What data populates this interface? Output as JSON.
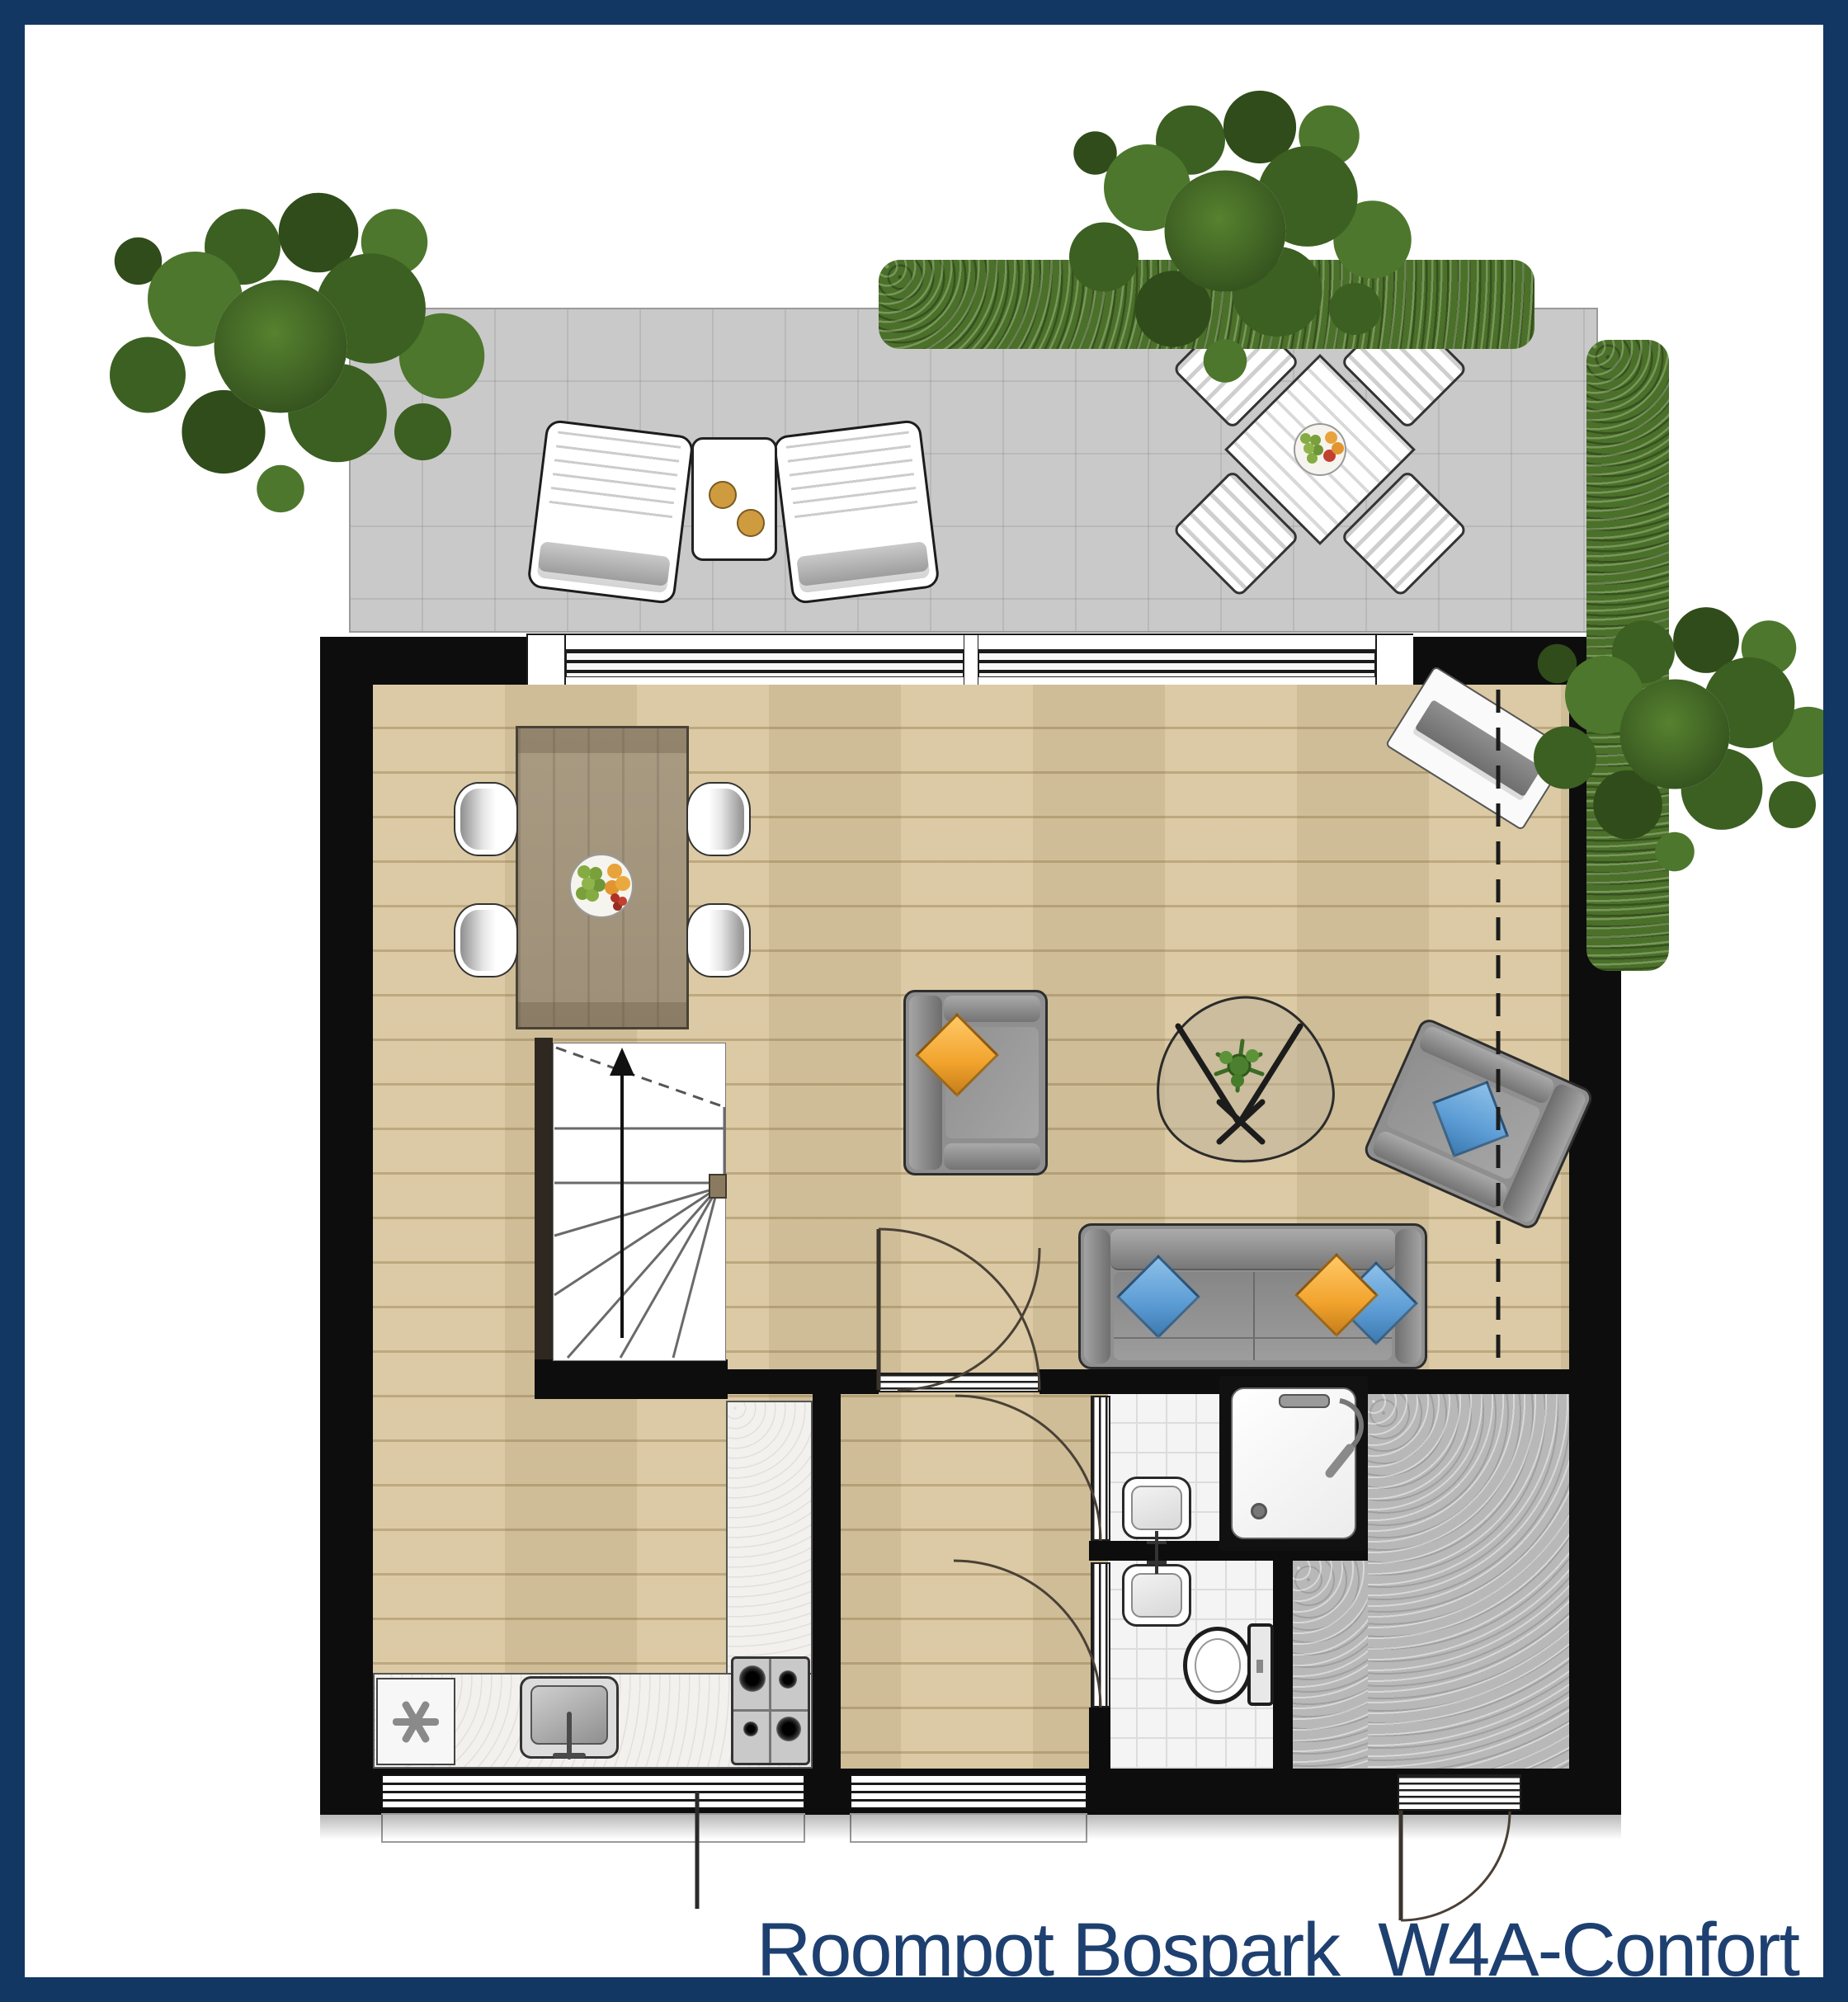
{
  "title": {
    "label": "Roompot Bospark  W4A-Confort"
  },
  "colors": {
    "navy_frame": "#123763",
    "navy_text": "#1e4070",
    "wall": "#0d0d0d",
    "wood": "#d9c79f",
    "wood_line": "#c2ab7e",
    "terrace": "#c9c9c9",
    "terrace_line": "#b4b4b4",
    "hall": "#b8b8b8",
    "tile": "#f4f4f4",
    "tile_line": "#dcdcdc",
    "counter": "#f2f1ee",
    "table_wood": "#a59681",
    "table_wood_dark": "#8d7f6c",
    "sofa": "#8f8f8f",
    "sofa_dark": "#6f6f6f",
    "sofa_outline": "#2d2d2d",
    "cushion_orange": "#f2a32d",
    "cushion_blue": "#5b9bd4",
    "green_dark": "#35541f",
    "green_mid": "#4a7029",
    "green_light": "#65923a",
    "stair_wall": "#2e2820",
    "chair_white": "#ffffff"
  },
  "floorplan": {
    "unit_label": "W4A-Confort",
    "rooms": [
      {
        "name": "terrace",
        "floor": "grey-tiles"
      },
      {
        "name": "living-dining-area",
        "floor": "wood"
      },
      {
        "name": "kitchen",
        "floor": "wood"
      },
      {
        "name": "hallway",
        "floor": "wood"
      },
      {
        "name": "bathroom",
        "floor": "white-tiles",
        "fixtures": [
          "shower",
          "washbasin"
        ]
      },
      {
        "name": "toilet-room",
        "floor": "white-tiles",
        "fixtures": [
          "toilet",
          "washbasin"
        ]
      },
      {
        "name": "entrance-hall",
        "floor": "stone"
      }
    ],
    "furniture": [
      "lounge-chair",
      "lounge-chair",
      "lounge-side-table",
      "terrace-dining-table",
      "terrace-chair",
      "terrace-chair",
      "terrace-chair",
      "terrace-chair",
      "dining-table",
      "dining-chair",
      "dining-chair",
      "dining-chair",
      "dining-chair",
      "fruit-bowl",
      "armchair-orange-cushion",
      "coffee-table-with-plant",
      "armchair-blue-cushion",
      "sofa-three-cushions",
      "doormat",
      "staircase-up",
      "kitchen-counter",
      "freezer",
      "kitchen-sink",
      "gas-stove",
      "shower",
      "toilet",
      "washbasin",
      "washbasin"
    ],
    "outdoor": [
      "tree",
      "tree",
      "tree",
      "hedge-top",
      "hedge-right"
    ]
  }
}
